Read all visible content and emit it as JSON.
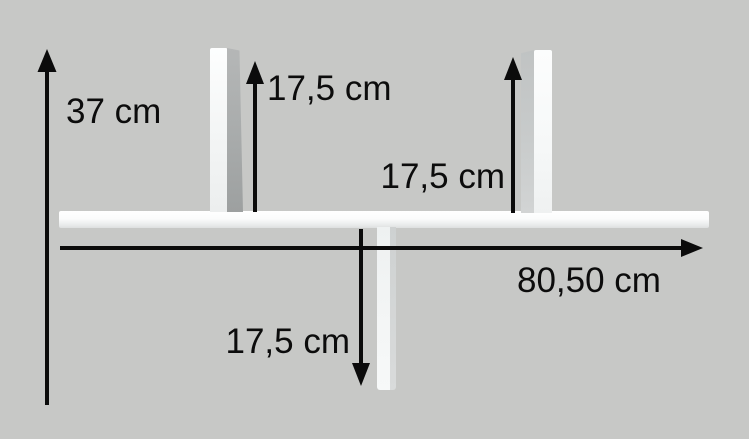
{
  "diagram": {
    "background_color": "#c7c8c6",
    "arrow_color": "#0b0b0b",
    "shelf_color": "#f5f7f7",
    "labels": {
      "total_height": "37 cm",
      "divider_top_left_height": "17,5 cm",
      "divider_top_right_height": "17,5 cm",
      "total_width": "80,50 cm",
      "divider_bottom_height": "17,5 cm"
    }
  }
}
